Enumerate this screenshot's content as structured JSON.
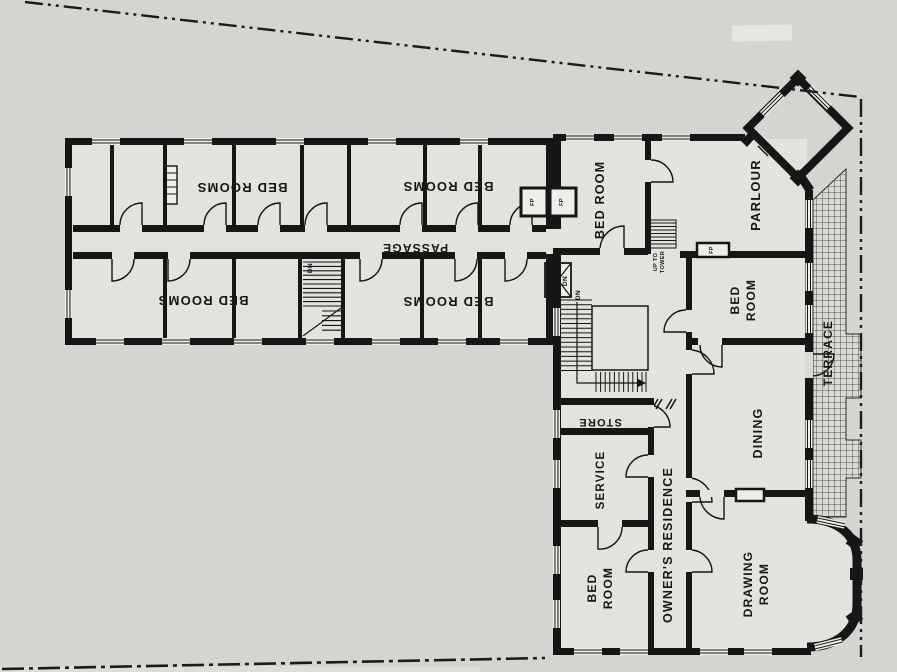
{
  "plan_type": "floor-plan",
  "colors": {
    "paper": "#d6d4d0",
    "interior": "#e4e2dd",
    "ink": "#161616",
    "terrace_fill": "#dbd9d4"
  },
  "rooms": {
    "bed_rooms_nw": "BED ROOMS",
    "bed_rooms_ne": "BED ROOMS",
    "bed_rooms_sw": "BED ROOMS",
    "bed_rooms_se": "BED ROOMS",
    "passage": "PASSAGE",
    "bed_room_north": "BED ROOM",
    "parlour": "PARLOUR",
    "bed_room_east": {
      "line1": "BED",
      "line2": "ROOM"
    },
    "terrace": "TERRACE",
    "dining": "DINING",
    "store": "STORE",
    "service": "SERVICE",
    "owners_residence": "OWNER'S RESIDENCE",
    "bed_room_south": {
      "line1": "BED",
      "line2": "ROOM"
    },
    "drawing_room": {
      "line1": "DRAWING",
      "line2": "ROOM"
    }
  },
  "annotations": {
    "dn": "DN",
    "fp": "FP",
    "up_to_tower": {
      "line1": "UP TO",
      "line2": "TOWER"
    }
  }
}
